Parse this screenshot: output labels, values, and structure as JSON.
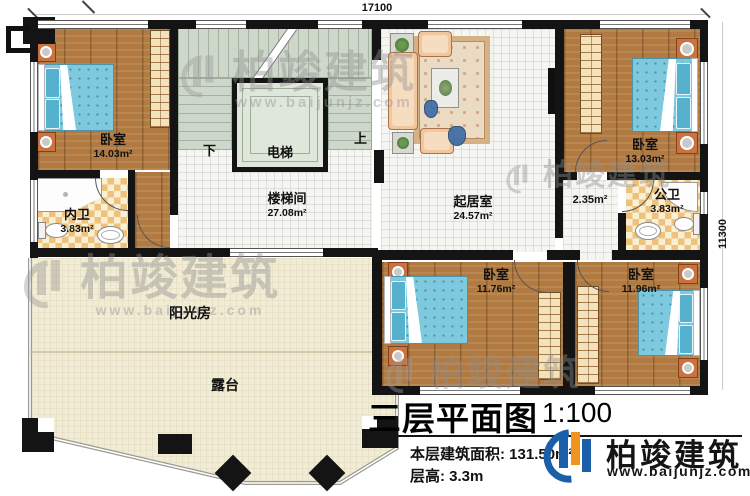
{
  "plan": {
    "title": "三层平面图",
    "scale": "1:100",
    "stats": [
      {
        "label": "本层建筑面积:",
        "value": "131.50m²"
      },
      {
        "label": "层高:",
        "value": "3.3m"
      }
    ]
  },
  "brand": {
    "name": "柏竣建筑",
    "website": "www.baijunjz.com"
  },
  "watermark": {
    "name": "柏竣建筑",
    "website": "www.baijunjz.com"
  },
  "dimensions": {
    "top": "17100",
    "right": "11300"
  },
  "stairs": {
    "up": "上",
    "down": "下"
  },
  "rooms": [
    {
      "name": "卧室",
      "area": "14.03m²"
    },
    {
      "name": "内卫",
      "area": "3.83m²"
    },
    {
      "name": "楼梯间",
      "area": "27.08m²"
    },
    {
      "name": "电梯",
      "area": ""
    },
    {
      "name": "起居室",
      "area": "24.57m²"
    },
    {
      "name": "卧室",
      "area": "13.03m²"
    },
    {
      "name": "",
      "area": "2.35m²"
    },
    {
      "name": "公卫",
      "area": "3.83m²"
    },
    {
      "name": "卧室",
      "area": "11.76m²"
    },
    {
      "name": "卧室",
      "area": "11.96m²"
    },
    {
      "name": "阳光房",
      "area": ""
    },
    {
      "name": "露台",
      "area": ""
    }
  ],
  "colors": {
    "wall": "#141414",
    "wood_floor": "#b07a42",
    "bed_blue": "#7ec9de",
    "bath_checker": "#eec27c",
    "stair_green": "#ced8ca",
    "terrace_beige": "#f1ecd6",
    "brand_blue": "#1b5fa8",
    "brand_orange": "#f0941f"
  }
}
